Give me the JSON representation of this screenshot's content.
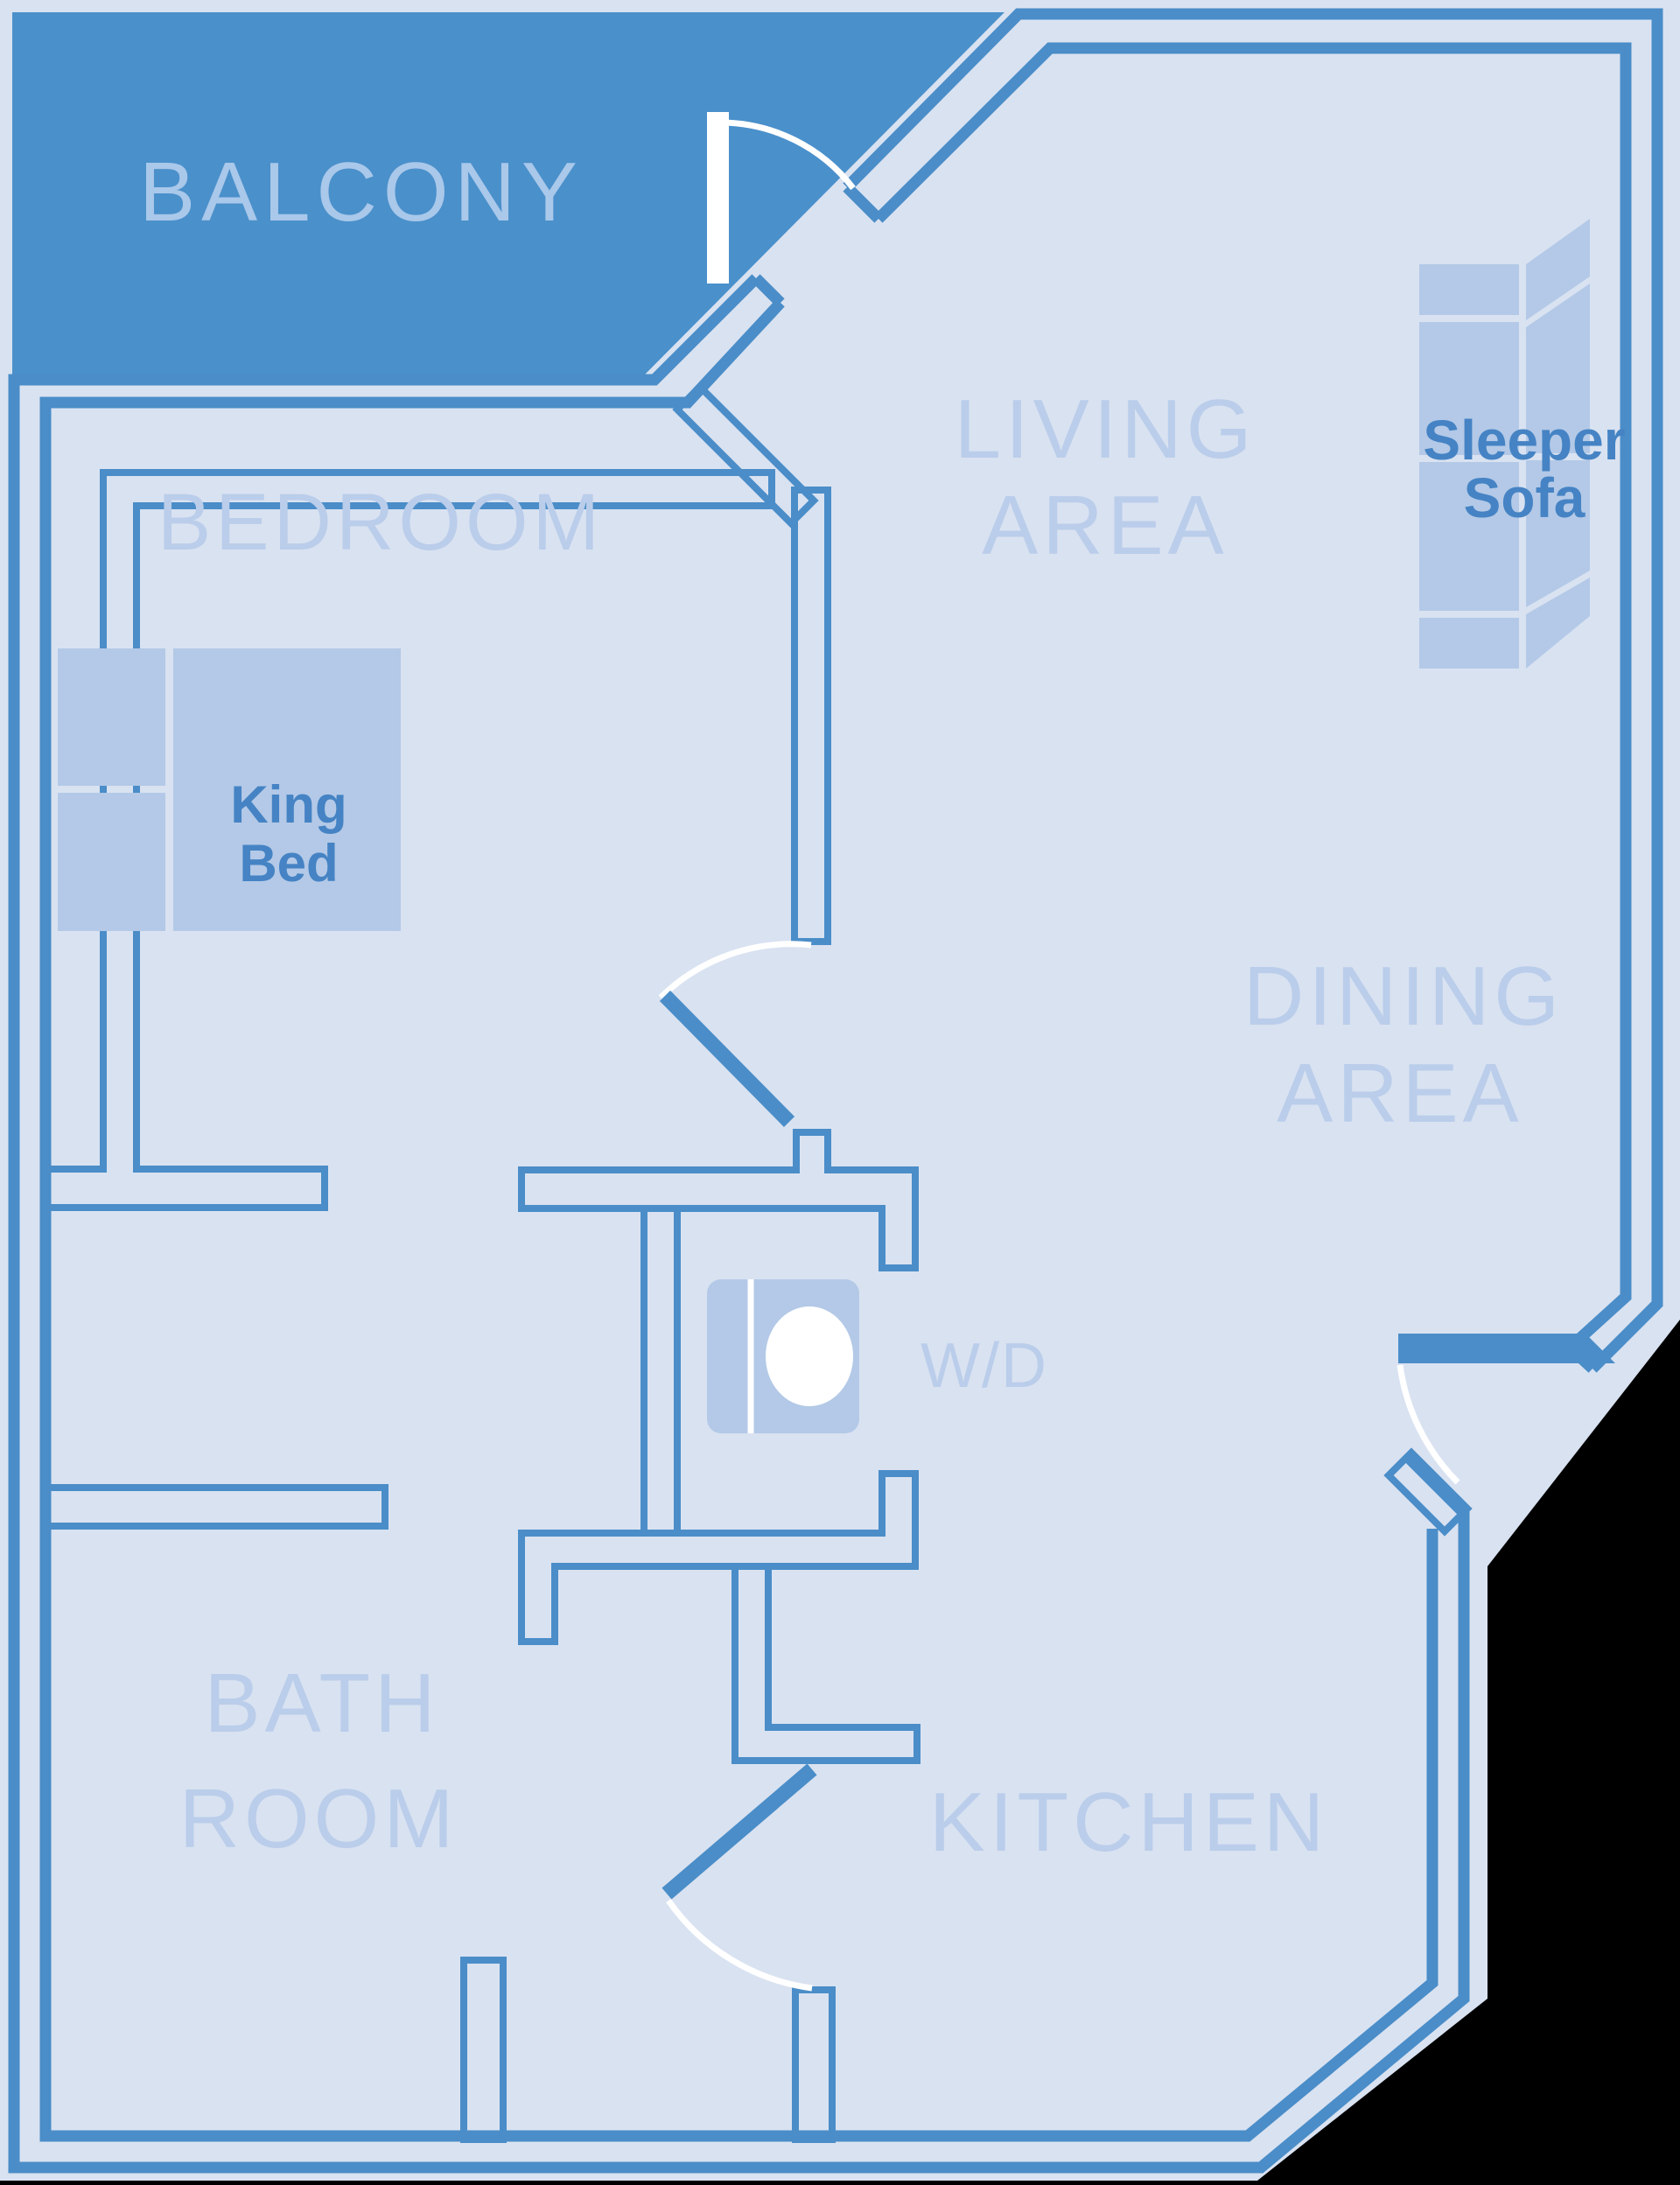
{
  "diagram_type": "hotel-suite-floor-plan",
  "rooms": {
    "balcony": {
      "label": "BALCONY"
    },
    "bedroom": {
      "label": "BEDROOM"
    },
    "living": {
      "line1": "LIVING",
      "line2": "AREA"
    },
    "dining": {
      "line1": "DINING",
      "line2": "AREA"
    },
    "bathroom": {
      "line1": "BATH",
      "line2": "ROOM"
    },
    "kitchen": {
      "label": "KITCHEN"
    },
    "laundry": {
      "label": "W/D"
    }
  },
  "furniture": {
    "king_bed": {
      "line1": "King",
      "line2": "Bed"
    },
    "sleeper_sofa": {
      "line1": "Sleeper",
      "line2": "Sofa"
    }
  },
  "colors": {
    "background": "#000000",
    "floor": "#d9e2f1",
    "wall": "#4a8dc8",
    "balcony": "#4a90cb",
    "furniture": "#b3c9e7",
    "room_label": "#bacdea",
    "furniture_label": "#4583c4",
    "balcony_label": "#a9c8ea",
    "door_arc": "#ffffff"
  }
}
